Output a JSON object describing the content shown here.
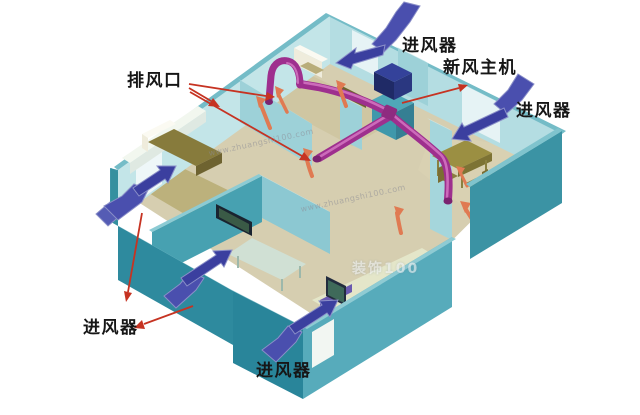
{
  "diagram": {
    "type": "home-fresh-air-ventilation-isometric",
    "labels": {
      "exhaust_outlet": "排风口",
      "fresh_air_unit": "新风主机",
      "air_inlet_top": "进风器",
      "air_inlet_right": "进风器",
      "air_inlet_bottom_left": "进风器",
      "air_inlet_bottom": "进风器"
    },
    "watermarks": {
      "site_url": "www.zhuangshi100.com",
      "logo": "装饰100"
    },
    "colors": {
      "wall_light_face": "#c3e5e8",
      "wall_mid_face": "#b4dde2",
      "wall_dark_face": "#2e8a9e",
      "wall_outer_right": "#3b93a4",
      "wall_top_strip": "#74bcc7",
      "floor_beige": "#d6ceb0",
      "duct_magenta": "#9e2f8e",
      "duct_highlight": "#d77ac6",
      "inlet_arrow_blue": "#3b3f9f",
      "exhaust_arrow_salmon": "#e07a52",
      "pointer_red": "#c63322",
      "unit_navy": "#1f2a66",
      "bed_olive": "#877b3c",
      "bed_pale": "#e8ead0"
    }
  }
}
